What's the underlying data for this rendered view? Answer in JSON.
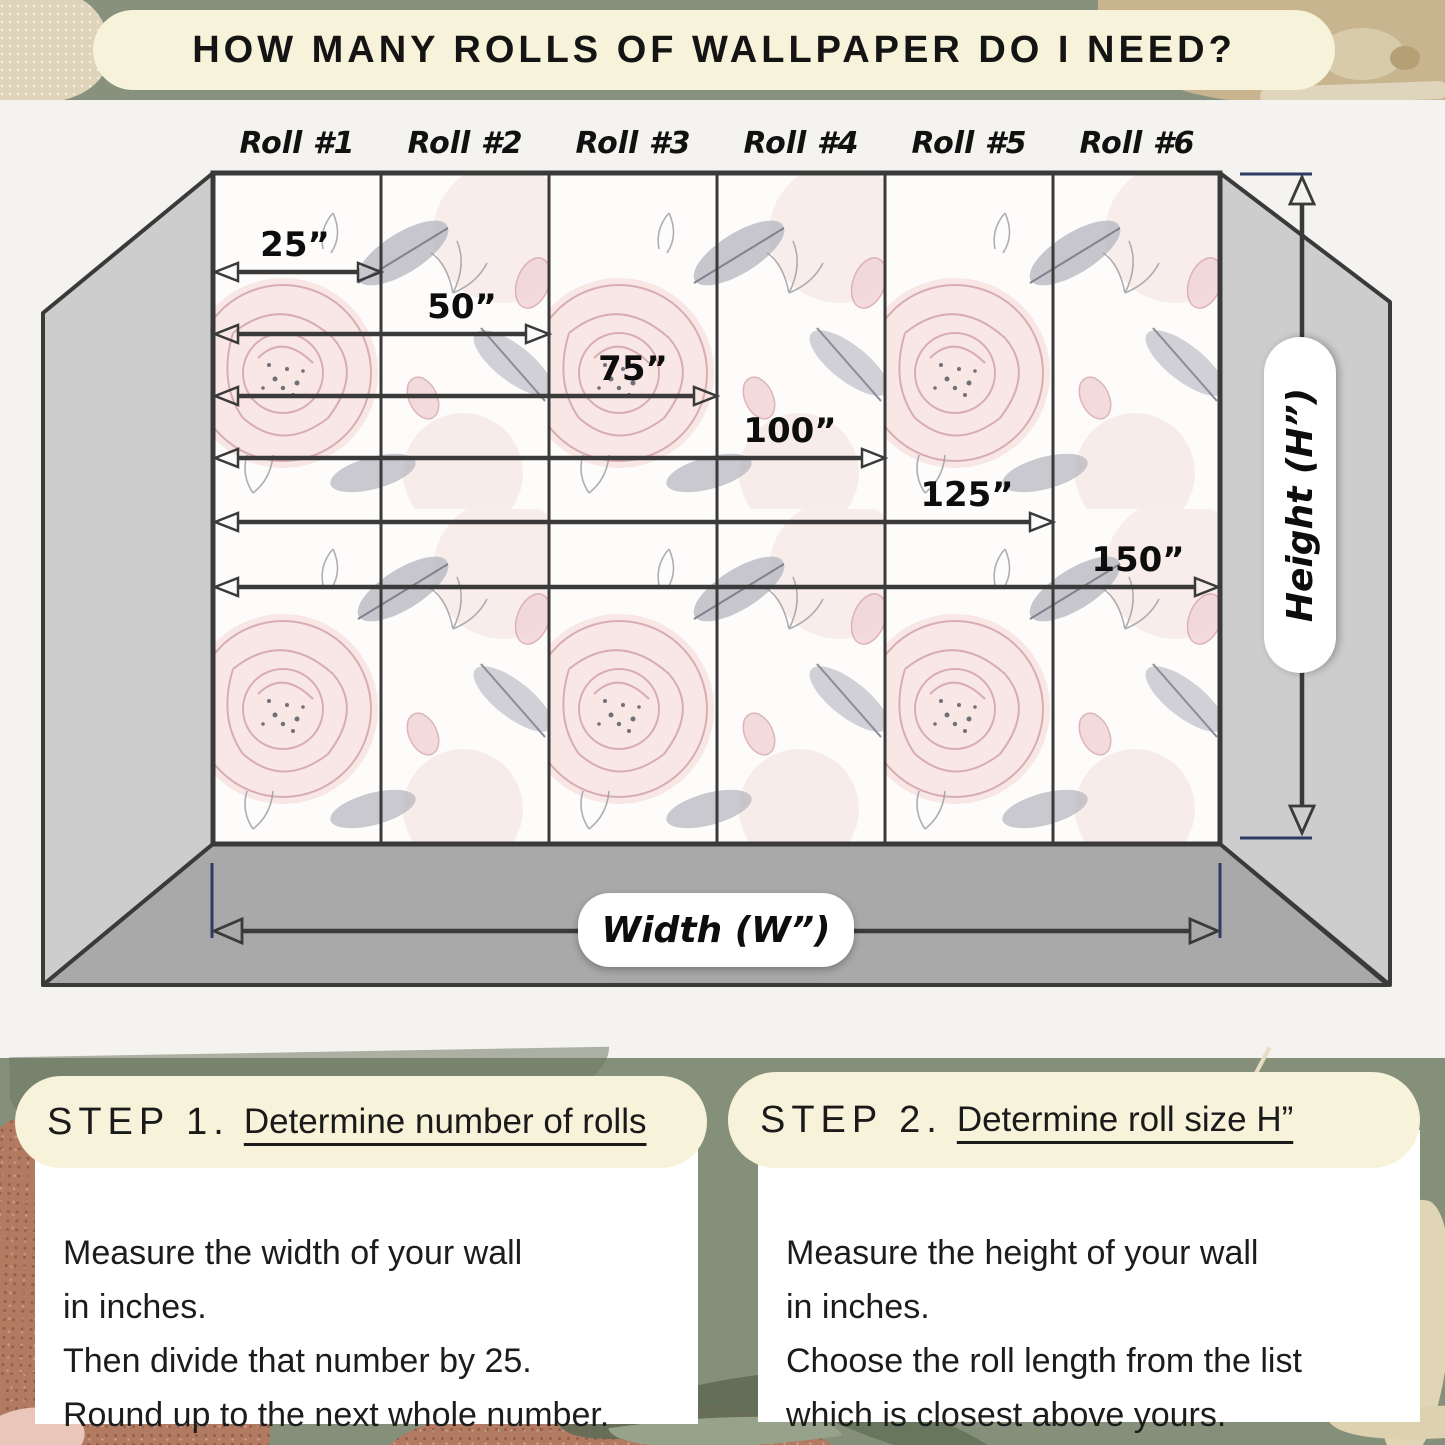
{
  "title": "HOW MANY ROLLS OF WALLPAPER DO I NEED?",
  "diagram": {
    "rolls": [
      {
        "label": "Roll #1"
      },
      {
        "label": "Roll #2"
      },
      {
        "label": "Roll #3"
      },
      {
        "label": "Roll #4"
      },
      {
        "label": "Roll #5"
      },
      {
        "label": "Roll #6"
      }
    ],
    "measurements": [
      {
        "label": "25”"
      },
      {
        "label": "50”"
      },
      {
        "label": "75”"
      },
      {
        "label": "100”"
      },
      {
        "label": "125”"
      },
      {
        "label": "150”"
      }
    ],
    "width_label": "Width (W”)",
    "height_label": "Height (H”)"
  },
  "steps": [
    {
      "step": "STEP 1.",
      "heading": "Determine number of rolls",
      "lines": [
        "Measure the width of your wall",
        "in inches.",
        "Then divide that number by 25.",
        "Round up to the next whole number."
      ]
    },
    {
      "step": "STEP 2.",
      "heading": "Determine roll size H”",
      "lines": [
        "Measure the height of your wall",
        "in inches.",
        "Choose the roll length from the list",
        "which is closest above yours."
      ]
    }
  ],
  "colors": {
    "cream": "#f7f3da",
    "sage_green": "#87917e",
    "floor_gray": "#a9a9a9",
    "side_wall_gray": "#cdcdcd",
    "outline": "#3a3a3a",
    "tick_navy": "#2f3a66"
  }
}
